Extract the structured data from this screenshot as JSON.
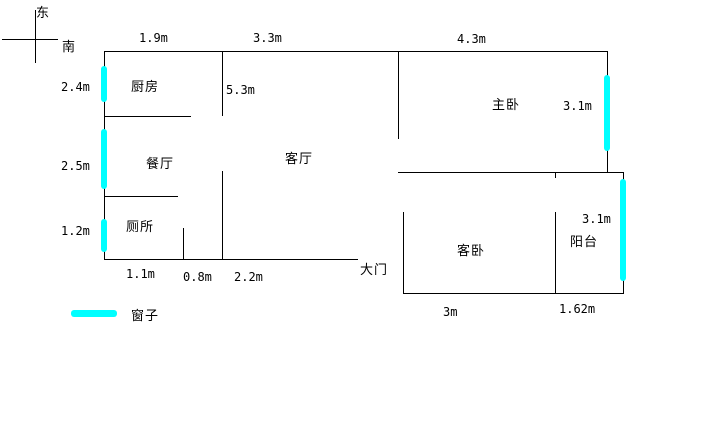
{
  "compass": {
    "east": "东",
    "south": "南"
  },
  "rooms": {
    "kitchen": "厨房",
    "dining": "餐厅",
    "toilet": "厕所",
    "living": "客厅",
    "master_bedroom": "主卧",
    "guest_bedroom": "客卧",
    "balcony": "阳台"
  },
  "door": {
    "main_door": "大门"
  },
  "legend": {
    "window": "窗子"
  },
  "measurements": {
    "top": [
      "1.9m",
      "3.3m",
      "4.3m"
    ],
    "left": [
      "2.4m",
      "2.5m",
      "1.2m"
    ],
    "living_room_depth": "5.3m",
    "master_window": "3.1m",
    "balcony_window": "3.1m",
    "bottom": [
      "1.1m",
      "0.8m",
      "2.2m"
    ],
    "guest_bedroom_width": "3m",
    "balcony_width": "1.62m"
  },
  "colors": {
    "wall": "#000000",
    "window": "#00ffff",
    "background": "#ffffff"
  }
}
